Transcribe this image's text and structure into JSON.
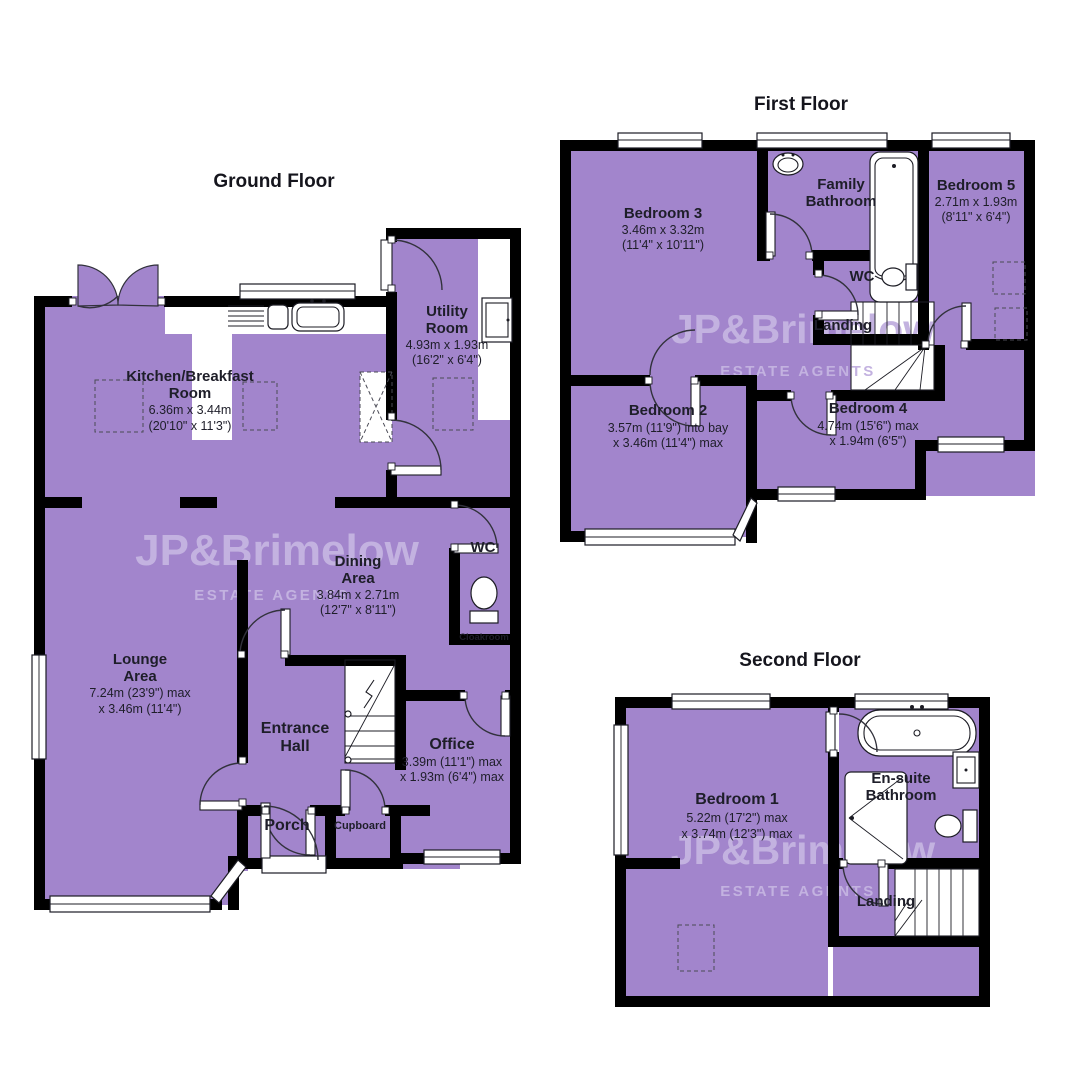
{
  "watermark": {
    "line1": "JP&Brimelow",
    "line2": "ESTATE AGENTS"
  },
  "colors": {
    "room_fill": "#a285cc",
    "wall": "#000000",
    "label_text": "#1e1e29",
    "watermark": "#c3b2e0",
    "background": "#ffffff"
  },
  "ground": {
    "title": "Ground Floor",
    "kitchen": {
      "name1": "Kitchen/Breakfast",
      "name2": "Room",
      "dim1": "6.36m x 3.44m",
      "dim2": "(20'10\" x 11'3\")"
    },
    "utility": {
      "name1": "Utility",
      "name2": "Room",
      "dim1": "4.93m x 1.93m",
      "dim2": "(16'2\" x 6'4\")"
    },
    "lounge": {
      "name1": "Lounge",
      "name2": "Area",
      "dim1": "7.24m (23'9\") max",
      "dim2": "x 3.46m (11'4\")"
    },
    "dining": {
      "name1": "Dining",
      "name2": "Area",
      "dim1": "3.84m x 2.71m",
      "dim2": "(12'7\" x 8'11\")"
    },
    "wc": {
      "name": "WC"
    },
    "cloakroom": {
      "name": "Cloakroom"
    },
    "hall": {
      "name1": "Entrance",
      "name2": "Hall"
    },
    "office": {
      "name": "Office",
      "dim1": "3.39m (11'1\") max",
      "dim2": "x 1.93m (6'4\") max"
    },
    "porch": {
      "name": "Porch"
    },
    "cupboard": {
      "name": "Cupboard"
    }
  },
  "first": {
    "title": "First Floor",
    "bedroom3": {
      "name": "Bedroom 3",
      "dim1": "3.46m x 3.32m",
      "dim2": "(11'4\" x 10'11\")"
    },
    "bathroom": {
      "name1": "Family",
      "name2": "Bathroom"
    },
    "bedroom5": {
      "name": "Bedroom 5",
      "dim1": "2.71m x 1.93m",
      "dim2": "(8'11\" x 6'4\")"
    },
    "wc": {
      "name": "WC"
    },
    "landing": {
      "name": "Landing"
    },
    "bedroom2": {
      "name": "Bedroom 2",
      "dim1": "3.57m (11'9\") into bay",
      "dim2": "x 3.46m (11'4\") max"
    },
    "bedroom4": {
      "name": "Bedroom 4",
      "dim1": "4.74m (15'6\") max",
      "dim2": "x 1.94m (6'5\")"
    }
  },
  "second": {
    "title": "Second Floor",
    "bedroom1": {
      "name": "Bedroom 1",
      "dim1": "5.22m (17'2\") max",
      "dim2": "x 3.74m (12'3\") max"
    },
    "ensuite": {
      "name1": "En-suite",
      "name2": "Bathroom"
    },
    "landing": {
      "name": "Landing"
    }
  }
}
